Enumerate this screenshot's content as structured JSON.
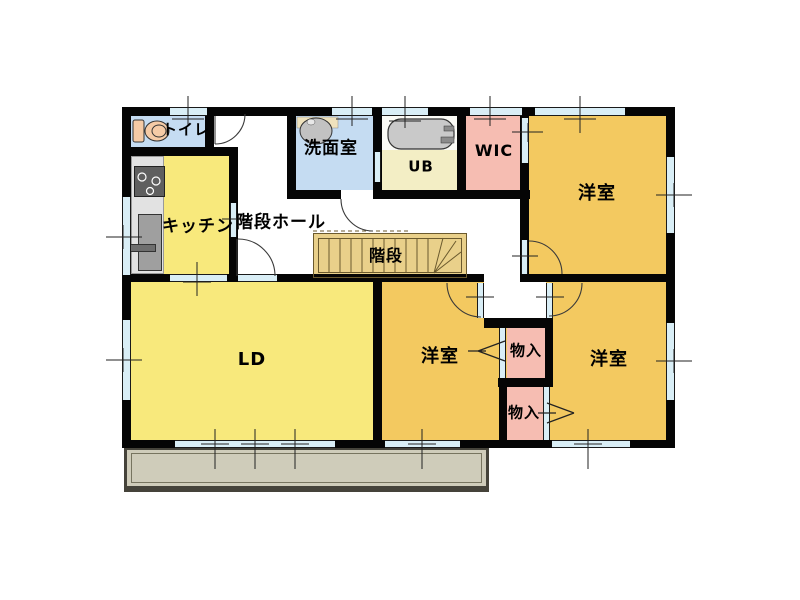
{
  "plan_title": "2F floor plan",
  "rooms": {
    "toilet": {
      "label": "トイレ"
    },
    "kitchen": {
      "label": "キッチン"
    },
    "stair_hall": {
      "label": "階段ホール"
    },
    "washroom": {
      "label": "洗面室"
    },
    "unit_bath": {
      "label": "UB"
    },
    "wic": {
      "label": "WIC"
    },
    "stairs": {
      "label": "階段"
    },
    "living_dining": {
      "label": "LD"
    },
    "bedroom_top_right": {
      "label": "洋室"
    },
    "bedroom_bottom_middle": {
      "label": "洋室"
    },
    "bedroom_bottom_right": {
      "label": "洋室"
    },
    "storage_upper": {
      "label": "物入"
    },
    "storage_lower": {
      "label": "物入"
    }
  },
  "colors": {
    "wall": "#050505",
    "water_rooms_blue": "#c5dcf2",
    "kitchen_ld_yellow": "#f8e97c",
    "bedroom_orange": "#f3c960",
    "closet_pink": "#f6bdb2",
    "unit_bath_cream": "#f3eec5",
    "stairs_tan": "#e9d08a",
    "opening_cyan": "#d9eef6",
    "balcony_gray": "#cfccba"
  }
}
